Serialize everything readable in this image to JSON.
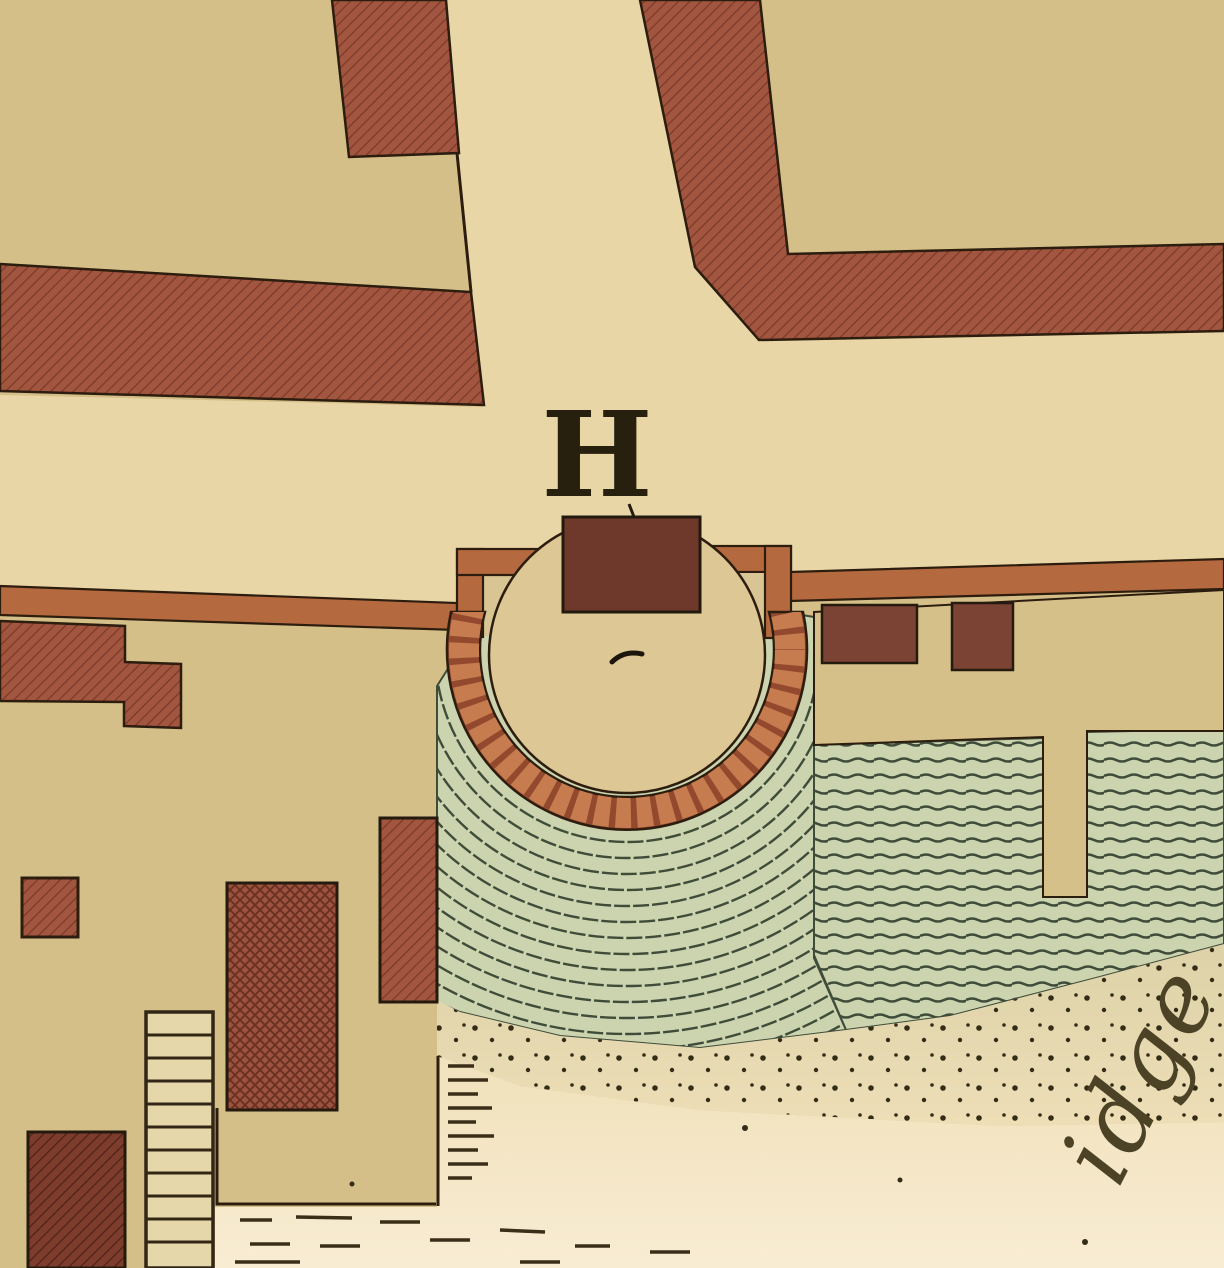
{
  "map": {
    "labels": {
      "building_label": "H",
      "shore_text_fragment": "idge"
    },
    "palette": {
      "parchment_tan": "#d5bf88",
      "street_cream": "#e9d6a6",
      "building_red_hatch": "#a3563f",
      "building_red_dark": "#6e392b",
      "quay_wall_orange": "#b5693f",
      "bastion_brick_light": "#c67c4e",
      "steps_green_light": "#ccd4af",
      "steps_green_dark": "#3f4c39",
      "shore_cream": "#f5e7c8",
      "ink_outline": "#2c1d0f",
      "script_ink": "#4c4226"
    },
    "features": {
      "crossroads": "street-crossing",
      "hatched_blocks": "city-building-blocks",
      "bastion": "semicircular-water-stair",
      "quay": "waterfront-wall",
      "steps": "stepped-riverbank",
      "shore": "sandy-shore",
      "jetty": "ladder-jetty"
    }
  }
}
